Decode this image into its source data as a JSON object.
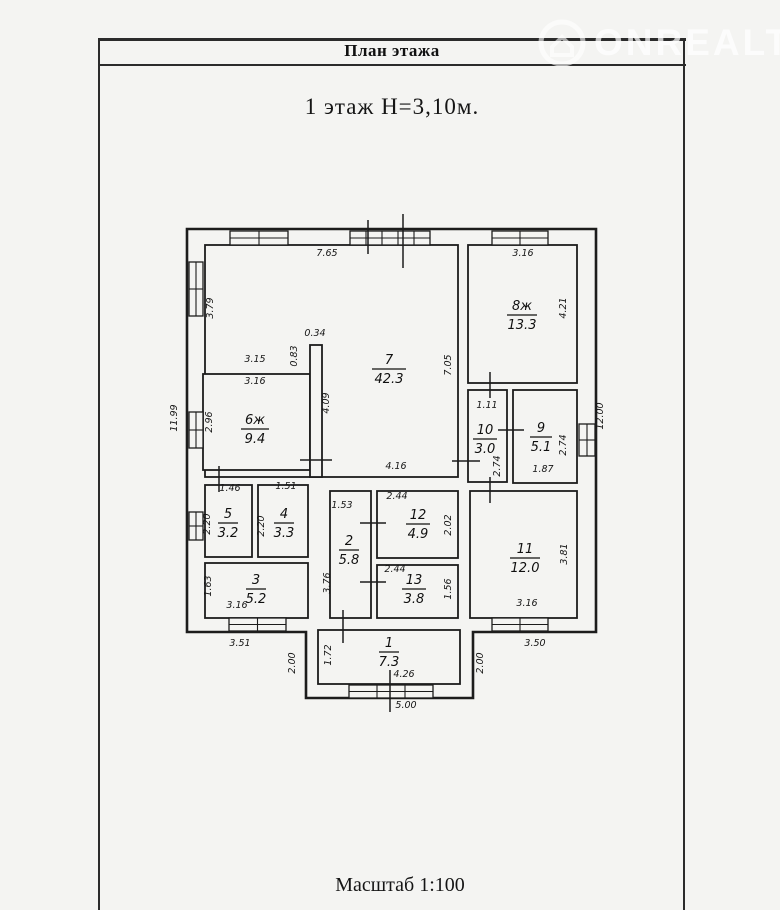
{
  "page": {
    "header_title": "План этажа",
    "floor_title": "1 этаж  Н=3,10м.",
    "scale_label": "Масштаб 1:100",
    "watermark": {
      "text": "ONREALT"
    },
    "colors": {
      "line": "#1c1c1c",
      "paper": "#f4f4f2",
      "watermark": "#ffffff"
    }
  },
  "plan": {
    "envelope": "187,229 596,229 596,632 473,632 473,698 306,698 306,632 187,632",
    "rooms": [
      {
        "id": "7",
        "area": "42.3",
        "cx": 389,
        "cy": 368,
        "lw": 34,
        "box": [
          205,
          245,
          253,
          232
        ]
      },
      {
        "id": "8ж",
        "area": "13.3",
        "cx": 522,
        "cy": 314,
        "lw": 30,
        "box": [
          468,
          245,
          109,
          138
        ]
      },
      {
        "id": "6ж",
        "area": "9.4",
        "cx": 255,
        "cy": 428,
        "lw": 28,
        "box": [
          203,
          374,
          107,
          96
        ]
      },
      {
        "id": "10",
        "area": "3.0",
        "cx": 485,
        "cy": 438,
        "lw": 24,
        "box": [
          468,
          390,
          39,
          92
        ]
      },
      {
        "id": "9",
        "area": "5.1",
        "cx": 541,
        "cy": 436,
        "lw": 22,
        "box": [
          513,
          390,
          64,
          93
        ]
      },
      {
        "id": "11",
        "area": "12.0",
        "cx": 525,
        "cy": 557,
        "lw": 30,
        "box": [
          470,
          491,
          107,
          127
        ]
      },
      {
        "id": "12",
        "area": "4.9",
        "cx": 418,
        "cy": 523,
        "lw": 24,
        "box": [
          377,
          491,
          81,
          67
        ]
      },
      {
        "id": "13",
        "area": "3.8",
        "cx": 414,
        "cy": 588,
        "lw": 24,
        "box": [
          377,
          565,
          81,
          53
        ]
      },
      {
        "id": "5",
        "area": "3.2",
        "cx": 228,
        "cy": 522,
        "lw": 20,
        "box": [
          205,
          485,
          47,
          72
        ]
      },
      {
        "id": "4",
        "area": "3.3",
        "cx": 284,
        "cy": 522,
        "lw": 20,
        "box": [
          258,
          485,
          50,
          72
        ]
      },
      {
        "id": "3",
        "area": "5.2",
        "cx": 256,
        "cy": 588,
        "lw": 20,
        "box": [
          205,
          563,
          103,
          55
        ]
      },
      {
        "id": "2",
        "area": "5.8",
        "cx": 349,
        "cy": 549,
        "lw": 20,
        "box": [
          330,
          491,
          41,
          127
        ]
      },
      {
        "id": "1",
        "area": "7.3",
        "cx": 389,
        "cy": 651,
        "lw": 20,
        "box": [
          318,
          630,
          142,
          54
        ]
      }
    ],
    "extra_walls": [
      [
        310,
        345,
        12,
        132
      ]
    ],
    "windows": [
      {
        "x": 230,
        "y": 231,
        "w": 58,
        "h": 14,
        "dir": "h",
        "div": 1
      },
      {
        "x": 350,
        "y": 231,
        "w": 80,
        "h": 14,
        "dir": "h",
        "div": 4
      },
      {
        "x": 492,
        "y": 231,
        "w": 56,
        "h": 14,
        "dir": "h",
        "div": 1
      },
      {
        "x": 189,
        "y": 262,
        "w": 14,
        "h": 54,
        "dir": "v",
        "div": 1
      },
      {
        "x": 189,
        "y": 412,
        "w": 14,
        "h": 36,
        "dir": "v",
        "div": 1
      },
      {
        "x": 189,
        "y": 512,
        "w": 14,
        "h": 28,
        "dir": "v",
        "div": 1
      },
      {
        "x": 579,
        "y": 424,
        "w": 16,
        "h": 32,
        "dir": "v",
        "div": 1
      },
      {
        "x": 229,
        "y": 618,
        "w": 57,
        "h": 13,
        "dir": "h",
        "div": 1
      },
      {
        "x": 492,
        "y": 618,
        "w": 56,
        "h": 13,
        "dir": "h",
        "div": 1
      },
      {
        "x": 349,
        "y": 685,
        "w": 84,
        "h": 13,
        "dir": "h",
        "div": 2
      }
    ],
    "ticks": [
      [
        368,
        220,
        368,
        254
      ],
      [
        403,
        214,
        403,
        268
      ],
      [
        490,
        372,
        490,
        398
      ],
      [
        452,
        461,
        480,
        461
      ],
      [
        498,
        430,
        524,
        430
      ],
      [
        490,
        477,
        490,
        503
      ],
      [
        360,
        523,
        386,
        523
      ],
      [
        360,
        582,
        386,
        582
      ],
      [
        300,
        460,
        332,
        460
      ],
      [
        343,
        610,
        343,
        643
      ],
      [
        390,
        670,
        390,
        712
      ],
      [
        219,
        466,
        219,
        492
      ]
    ],
    "dims": [
      {
        "t": "7.65",
        "x": 327,
        "y": 256,
        "r": 0
      },
      {
        "t": "3.16",
        "x": 523,
        "y": 256,
        "r": 0
      },
      {
        "t": "3.79",
        "x": 213,
        "y": 308,
        "r": -90
      },
      {
        "t": "11.99",
        "x": 177,
        "y": 418,
        "r": -90
      },
      {
        "t": "12.00",
        "x": 603,
        "y": 416,
        "r": -90
      },
      {
        "t": "3.15",
        "x": 255,
        "y": 362,
        "r": 0
      },
      {
        "t": "0.34",
        "x": 315,
        "y": 336,
        "r": 0
      },
      {
        "t": "0.83",
        "x": 297,
        "y": 356,
        "r": -90
      },
      {
        "t": "7.05",
        "x": 451,
        "y": 365,
        "r": -90
      },
      {
        "t": "4.21",
        "x": 566,
        "y": 308,
        "r": -90
      },
      {
        "t": "3.16",
        "x": 255,
        "y": 384,
        "r": 0
      },
      {
        "t": "2.96",
        "x": 212,
        "y": 422,
        "r": -90
      },
      {
        "t": "4.09",
        "x": 329,
        "y": 403,
        "r": -90
      },
      {
        "t": "4.16",
        "x": 396,
        "y": 469,
        "r": 0
      },
      {
        "t": "1.11",
        "x": 487,
        "y": 408,
        "r": 0
      },
      {
        "t": "2.74",
        "x": 500,
        "y": 466,
        "r": -90
      },
      {
        "t": "1.87",
        "x": 543,
        "y": 472,
        "r": 0
      },
      {
        "t": "2.74",
        "x": 566,
        "y": 445,
        "r": -90
      },
      {
        "t": "1.46",
        "x": 230,
        "y": 491,
        "r": 0
      },
      {
        "t": "1.51",
        "x": 286,
        "y": 489,
        "r": 0
      },
      {
        "t": "2.20",
        "x": 210,
        "y": 524,
        "r": -90
      },
      {
        "t": "2.20",
        "x": 264,
        "y": 526,
        "r": -90
      },
      {
        "t": "1.53",
        "x": 342,
        "y": 508,
        "r": 0
      },
      {
        "t": "3.76",
        "x": 330,
        "y": 583,
        "r": -90
      },
      {
        "t": "2.44",
        "x": 397,
        "y": 499,
        "r": 0
      },
      {
        "t": "2.02",
        "x": 451,
        "y": 525,
        "r": -90
      },
      {
        "t": "2.44",
        "x": 395,
        "y": 572,
        "r": 0
      },
      {
        "t": "1.56",
        "x": 451,
        "y": 589,
        "r": -90
      },
      {
        "t": "3.81",
        "x": 567,
        "y": 554,
        "r": -90
      },
      {
        "t": "3.16",
        "x": 527,
        "y": 606,
        "r": 0
      },
      {
        "t": "1.63",
        "x": 211,
        "y": 586,
        "r": -90
      },
      {
        "t": "3.16",
        "x": 237,
        "y": 608,
        "r": 0
      },
      {
        "t": "3.51",
        "x": 240,
        "y": 646,
        "r": 0
      },
      {
        "t": "3.50",
        "x": 535,
        "y": 646,
        "r": 0
      },
      {
        "t": "2.00",
        "x": 295,
        "y": 663,
        "r": -90
      },
      {
        "t": "2.00",
        "x": 483,
        "y": 663,
        "r": -90
      },
      {
        "t": "1.72",
        "x": 331,
        "y": 655,
        "r": -90
      },
      {
        "t": "4.26",
        "x": 404,
        "y": 677,
        "r": 0
      },
      {
        "t": "5.00",
        "x": 406,
        "y": 708,
        "r": 0
      }
    ]
  }
}
